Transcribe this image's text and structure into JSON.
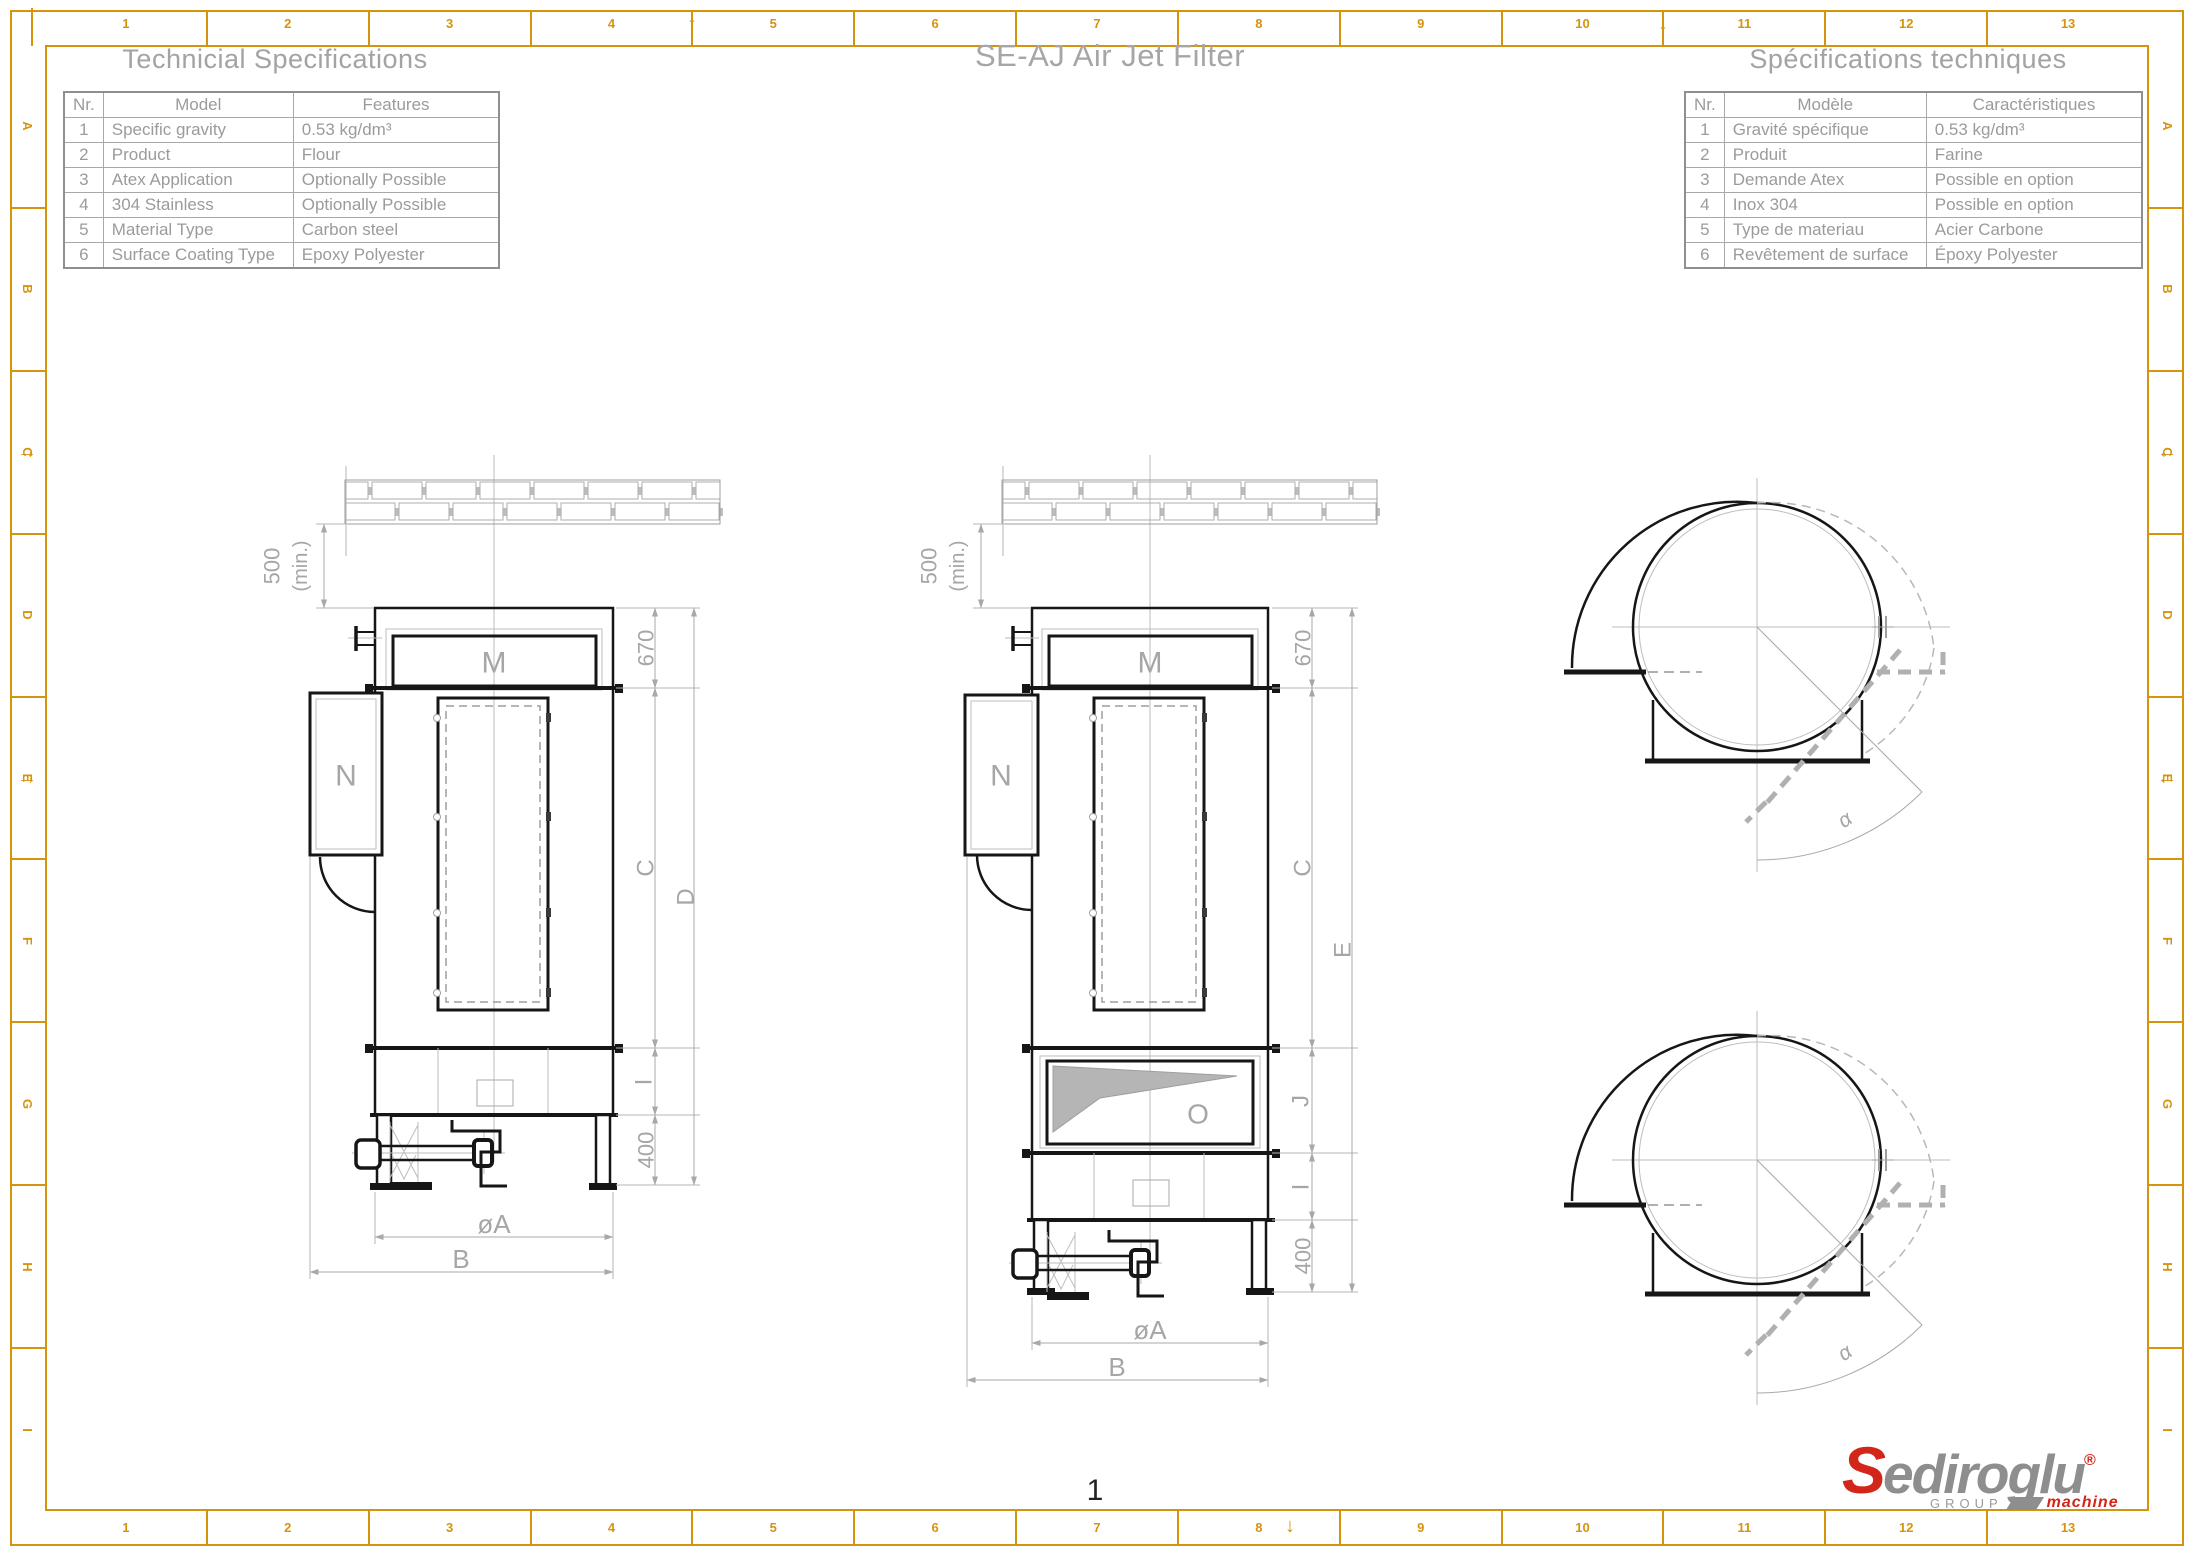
{
  "header": {
    "title": "SE-AJ Air Jet Filter"
  },
  "tables": {
    "english": {
      "title": "Technicial Specifications",
      "headers": [
        "Nr.",
        "Model",
        "Features"
      ],
      "rows": [
        [
          "1",
          "Specific gravity",
          "0.53 kg/dm³"
        ],
        [
          "2",
          "Product",
          "Flour"
        ],
        [
          "3",
          "Atex Application",
          "Optionally Possible"
        ],
        [
          "4",
          "304 Stainless",
          "Optionally Possible"
        ],
        [
          "5",
          "Material Type",
          "Carbon steel"
        ],
        [
          "6",
          "Surface Coating Type",
          "Epoxy Polyester"
        ]
      ]
    },
    "french": {
      "title": "Spécifications techniques",
      "headers": [
        "Nr.",
        "Modèle",
        "Caractéristiques"
      ],
      "rows": [
        [
          "1",
          "Gravité spécifique",
          "0.53 kg/dm³"
        ],
        [
          "2",
          "Produit",
          "Farine"
        ],
        [
          "3",
          "Demande Atex",
          "Possible en option"
        ],
        [
          "4",
          "Inox 304",
          "Possible en option"
        ],
        [
          "5",
          "Type de materiau",
          "Acier Carbone"
        ],
        [
          "6",
          "Revêtement de surface",
          "Époxy Polyester"
        ]
      ]
    }
  },
  "drawings": {
    "front_left": {
      "labels": {
        "m": "M",
        "n": "N"
      },
      "dims": {
        "clearance": "500",
        "clearance_note": "(min.)",
        "top_section": "670",
        "c": "C",
        "d": "D",
        "i": "I",
        "base": "400",
        "diameter": "øA",
        "width": "B"
      }
    },
    "front_right": {
      "labels": {
        "m": "M",
        "n": "N",
        "o": "O"
      },
      "dims": {
        "clearance": "500",
        "clearance_note": "(min.)",
        "top_section": "670",
        "c": "C",
        "e": "E",
        "j": "J",
        "i": "I",
        "base": "400",
        "diameter": "øA",
        "width": "B"
      }
    },
    "top_view": {
      "dims": {
        "angle": "α"
      }
    }
  },
  "frame": {
    "columns": [
      "1",
      "2",
      "3",
      "4",
      "5",
      "6",
      "7",
      "8",
      "9",
      "10",
      "11",
      "12",
      "13"
    ],
    "rows": [
      "A",
      "B",
      "C",
      "D",
      "E",
      "F",
      "G",
      "H",
      "I"
    ],
    "page_number": "1",
    "arrows": {
      "up": "↑",
      "down": "↓",
      "right": "→",
      "left": "←"
    }
  },
  "logo": {
    "initial": "S",
    "name": "ediroglu",
    "registered": "®",
    "group": "GROUP",
    "machine": "machine"
  },
  "colors": {
    "frame": "#D6940E",
    "drawing_black": "#161616",
    "dimension_gray": "#a6a6a6",
    "logo_red": "#d3261a",
    "logo_gray": "#8e8e8e"
  }
}
